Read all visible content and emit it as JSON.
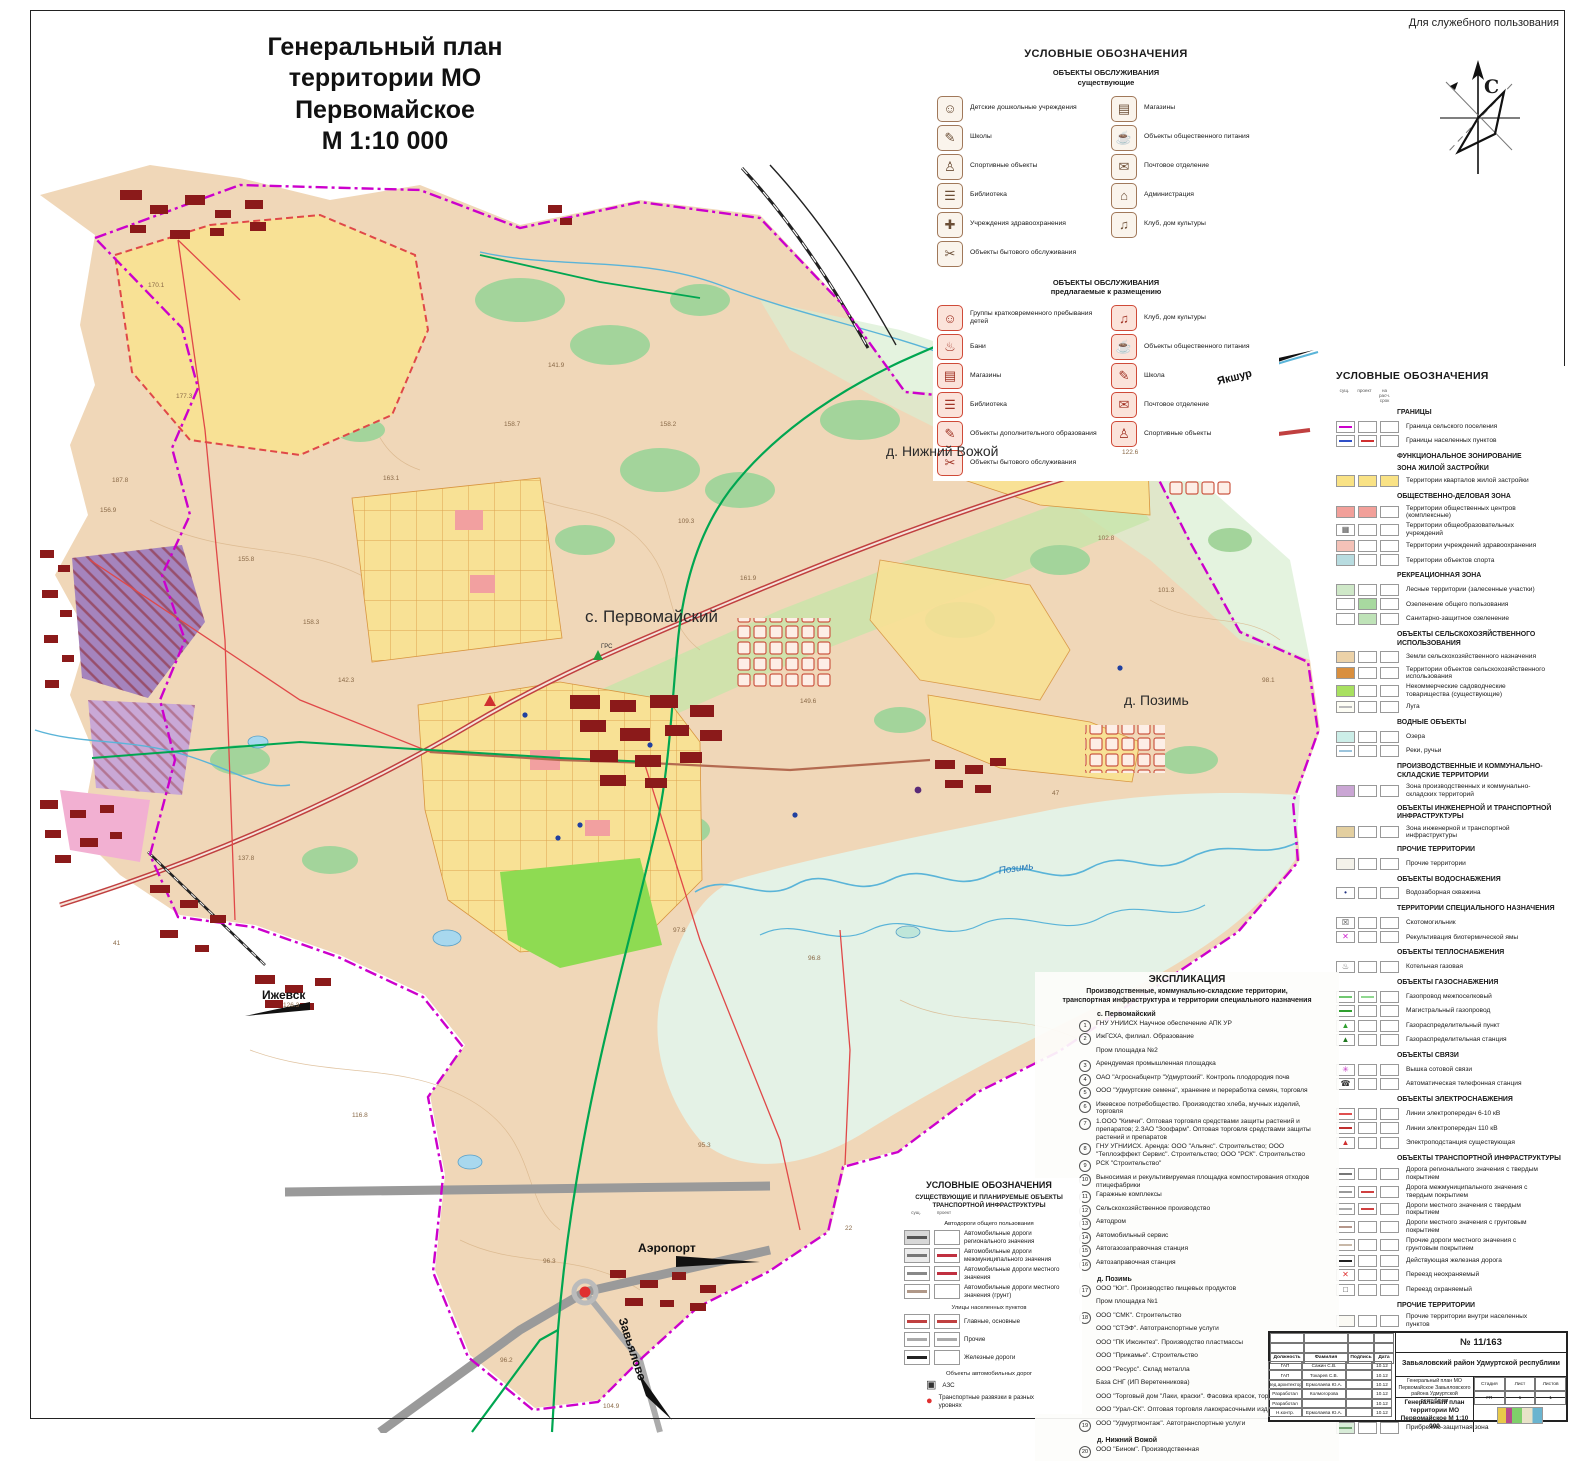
{
  "page": {
    "dsp_note": "Для служебного пользования",
    "title_line1": "Генеральный план",
    "title_line2": "территории МО Первомайское",
    "title_line3": "М 1:10 000",
    "compass_letter": "С"
  },
  "palette": {
    "boundary_magenta": "#cc00cc",
    "residential_yellow": "#f8e195",
    "forest_green": "#a3d49b",
    "gas_green": "#00a651",
    "power_red": "#e04848",
    "industrial_purple": "#a584bd",
    "water_blue": "#5ab4d8",
    "land_tan": "#f0d7b8"
  },
  "services_legend": {
    "title": "УСЛОВНЫЕ ОБОЗНАЧЕНИЯ",
    "existing": {
      "heading1": "ОБЪЕКТЫ ОБСЛУЖИВАНИЯ",
      "heading2": "существующие",
      "left": [
        {
          "icon": "☺",
          "label": "Детские дошкольные учреждения"
        },
        {
          "icon": "✎",
          "label": "Школы"
        },
        {
          "icon": "♙",
          "label": "Спортивные объекты"
        },
        {
          "icon": "☰",
          "label": "Библиотека"
        },
        {
          "icon": "✚",
          "label": "Учреждения здравоохранения"
        },
        {
          "icon": "✂",
          "label": "Объекты бытового обслуживания"
        }
      ],
      "right": [
        {
          "icon": "▤",
          "label": "Магазины"
        },
        {
          "icon": "☕",
          "label": "Объекты общественного питания"
        },
        {
          "icon": "✉",
          "label": "Почтовое отделение"
        },
        {
          "icon": "⌂",
          "label": "Администрация"
        },
        {
          "icon": "♫",
          "label": "Клуб, дом культуры"
        }
      ]
    },
    "proposed": {
      "heading1": "ОБЪЕКТЫ ОБСЛУЖИВАНИЯ",
      "heading2": "предлагаемые к размещению",
      "left": [
        {
          "icon": "☺",
          "label": "Группы кратковременного пребывания детей"
        },
        {
          "icon": "♨",
          "label": "Бани"
        },
        {
          "icon": "▤",
          "label": "Магазины"
        },
        {
          "icon": "☰",
          "label": "Библиотека"
        },
        {
          "icon": "✎",
          "label": "Объекты дополнительного образования"
        },
        {
          "icon": "✂",
          "label": "Объекты бытового обслуживания"
        }
      ],
      "right": [
        {
          "icon": "♫",
          "label": "Клуб, дом культуры"
        },
        {
          "icon": "☕",
          "label": "Объекты общественного питания"
        },
        {
          "icon": "✎",
          "label": "Школа"
        },
        {
          "icon": "✉",
          "label": "Почтовое отделение"
        },
        {
          "icon": "♙",
          "label": "Спортивные объекты"
        }
      ]
    }
  },
  "right_legend": {
    "title": "УСЛОВНЫЕ ОБОЗНАЧЕНИЯ",
    "col_headers": [
      "сущ.",
      "проект",
      "на расч. срок"
    ],
    "rows": [
      {
        "head": "ГРАНИЦЫ",
        "label": "Граница сельского поселения",
        "lc": "#cc00cc"
      },
      {
        "label": "Границы населенных пунктов",
        "lc": "#3050c8",
        "lc2": "#d03030"
      },
      {
        "head": "ФУНКЦИОНАЛЬНОЕ ЗОНИРОВАНИЕ",
        "sub": "ЗОНА ЖИЛОЙ ЗАСТРОЙКИ",
        "label": "Территории кварталов жилой застройки",
        "c": "#f9e285",
        "c2": "#f9e285",
        "c3": "#f9e285"
      },
      {
        "head": "ОБЩЕСТВЕННО-ДЕЛОВАЯ ЗОНА",
        "label": "Территории общественных центров (комплексные)",
        "c": "#f2a09a",
        "c2": "#f2a09a"
      },
      {
        "label": "Территории общеобразовательных учреждений",
        "sym": "▦",
        "symc": "#555"
      },
      {
        "label": "Территории учреждений здравоохранения",
        "c": "#f4c2b8"
      },
      {
        "label": "Территории объектов спорта",
        "c": "#b8dce0"
      },
      {
        "head": "РЕКРЕАЦИОННАЯ ЗОНА",
        "label": "Лесные территории (залесенные участки)",
        "c": "#cfe8c8"
      },
      {
        "label": "Озеленение общего пользования",
        "c2": "#a8d9a0"
      },
      {
        "label": "Санитарно-защитное озеленение",
        "c2": "#bfe3b8"
      },
      {
        "head": "ОБЪЕКТЫ СЕЛЬСКОХОЗЯЙСТВЕННОГО ИСПОЛЬЗОВАНИЯ",
        "label": "Земли сельскохозяйственного назначения",
        "c": "#ecd2a8"
      },
      {
        "label": "Территории объектов сельскохозяйственного использования",
        "c": "#d98f3e"
      },
      {
        "label": "Некоммерческие садоводческие товарищества (существующие)",
        "c": "#a8e060"
      },
      {
        "label": "Луга",
        "c": "#fdfdf4",
        "lc": "#bbb"
      },
      {
        "head": "ВОДНЫЕ ОБЪЕКТЫ",
        "label": "Озера",
        "c": "#cceee8"
      },
      {
        "label": "Реки, ручьи",
        "lc": "#9bc4dc"
      },
      {
        "head": "ПРОИЗВОДСТВЕННЫЕ И КОММУНАЛЬНО-СКЛАДСКИЕ ТЕРРИТОРИИ",
        "label": "Зона производственных и коммунально-складских территорий",
        "c": "#caa6d4"
      },
      {
        "head": "ОБЪЕКТЫ ИНЖЕНЕРНОЙ И ТРАНСПОРТНОЙ ИНФРАСТРУКТУРЫ",
        "label": "Зона инженерной и транспортной инфраструктуры",
        "c": "#e3cfa0"
      },
      {
        "head": "ПРОЧИЕ ТЕРРИТОРИИ",
        "label": "Прочие территории",
        "c": "#f4f2ea"
      },
      {
        "head": "ОБЪЕКТЫ ВОДОСНАБЖЕНИЯ",
        "label": "Водозаборная скважина",
        "sym": "•",
        "symc": "#203080"
      },
      {
        "head": "ТЕРРИТОРИИ СПЕЦИАЛЬНОГО НАЗНАЧЕНИЯ",
        "label": "Скотомогильник",
        "sym": "☒",
        "symc": "#444"
      },
      {
        "label": "Рекультивация биотермической ямы",
        "sym": "✕",
        "symc": "#d020d0"
      },
      {
        "head": "ОБЪЕКТЫ ТЕПЛОСНАБЖЕНИЯ",
        "label": "Котельная газовая",
        "sym": "♨",
        "symc": "#555"
      },
      {
        "head": "ОБЪЕКТЫ ГАЗОСНАБЖЕНИЯ",
        "label": "Газопровод межпоселковый",
        "lc": "#70c870",
        "lc2": "#90d890"
      },
      {
        "label": "Магистральный газопровод",
        "lc": "#30a030"
      },
      {
        "label": "Газораспределительный пункт",
        "sym": "▲",
        "symc": "#30a030"
      },
      {
        "label": "Газораспределительная станция",
        "sym": "▲",
        "symc": "#207820"
      },
      {
        "head": "ОБЪЕКТЫ СВЯЗИ",
        "label": "Вышка сотовой связи",
        "sym": "✳",
        "symc": "#c030c0"
      },
      {
        "label": "Автоматическая телефонная станция",
        "sym": "☎",
        "symc": "#333"
      },
      {
        "head": "ОБЪЕКТЫ ЭЛЕКТРОСНАБЖЕНИЯ",
        "label": "Линии электропередач 6-10 кВ",
        "lc": "#e05050"
      },
      {
        "label": "Линии электропередач 110 кВ",
        "lc": "#c03030"
      },
      {
        "label": "Электроподстанция  существующая",
        "sym": "▲",
        "symc": "#d03030"
      },
      {
        "head": "ОБЪЕКТЫ ТРАНСПОРТНОЙ ИНФРАСТРУКТУРЫ",
        "label": "Дорога регионального значения с твердым покрытием",
        "lc": "#777"
      },
      {
        "label": "Дорога межмуниципального значения с твердым покрытием",
        "lc": "#999",
        "lc2": "#d04040"
      },
      {
        "label": "Дороги местного значения с твердым покрытием",
        "lc": "#aaa",
        "lc2": "#d04040"
      },
      {
        "label": "Дороги местного значения с грунтовым покрытием",
        "lc": "#b5968a"
      },
      {
        "label": "Прочие дороги местного значения с грунтовым покрытием",
        "lc": "#c8b8a8"
      },
      {
        "label": "Действующая железная дорога",
        "lc": "#222"
      },
      {
        "label": "Переезд неохраняемый",
        "sym": "✕",
        "symc": "#e03030"
      },
      {
        "label": "Переезд охраняемый",
        "sym": "□",
        "symc": "#333"
      },
      {
        "head": "ПРОЧИЕ ТЕРРИТОРИИ",
        "label": "Прочие территории внутри населенных пунктов",
        "c": "#fbfaf4"
      },
      {
        "head": "ЗОНЫ С ОСОБЫМИ УСЛОВИЯМИ",
        "label": "Санитарно-защитная зона",
        "c": "#e4e4e4",
        "lc": "#888"
      },
      {
        "label": "Водоохранная зона",
        "c": "#eef2fa",
        "lc": "#4878c8"
      },
      {
        "label": "Полоса отвода от газопровода",
        "c": "#c2ecc2"
      },
      {
        "label": "Полоса отвода от линии электропередач",
        "c": "#ddc2e0"
      },
      {
        "label": "Зона санитарной охраны и источников питьевого водоснабжения I пояса",
        "c": "#f0c2dc",
        "lc": "#c050a0"
      },
      {
        "label": "Прибрежно-защитная зона",
        "c": "#d8ecd8",
        "lc": "#70a070"
      }
    ]
  },
  "explication": {
    "title": "ЭКСПЛИКАЦИЯ",
    "subtitle1": "Производственные, коммунально-складские территории,",
    "subtitle2": "транспортная инфраструктура и территории специального назначения",
    "rows": [
      {
        "head": "с. Первомайский",
        "n": "1",
        "text": "ГНУ УНИИСХ Научное обеспечение АПК УР"
      },
      {
        "n": "2",
        "text": "ИжГСХА, филиал. Образование"
      },
      {
        "n": "",
        "text": "Пром площадка №2"
      },
      {
        "n": "3",
        "text": "Арендуемая промышленная площадка"
      },
      {
        "n": "4",
        "text": "ОАО \"Агроснабцентр \"Удмуртский\". Контроль плодородия почв"
      },
      {
        "n": "5",
        "text": "ООО \"Удмуртские семена\", хранение и переработка семян, торговля"
      },
      {
        "n": "6",
        "text": "Ижевское потребобщество. Производство хлеба, мучных изделий, торговля"
      },
      {
        "n": "7",
        "text": "1.ООО \"Кимчи\". Оптовая торговля средствами защиты растений и препаратов; 2.ЗАО \"Зоофарм\". Оптовая торговля средствами защиты растений и препаратов"
      },
      {
        "n": "8",
        "text": "ГНУ УГНИИСХ. Аренда: ООО \"Альянс\". Строительство; ООО \"Теплоэффект Сервис\". Строительство; ООО \"РСК\". Строительство"
      },
      {
        "n": "9",
        "text": "РСК \"Строительство\""
      },
      {
        "n": "10",
        "text": "Выносимая и рекультивируемая площадка компостирования отходов птицефабрики"
      },
      {
        "n": "11",
        "text": "Гаражные комплексы"
      },
      {
        "n": "12",
        "text": "Сельскохозяйственное производство"
      },
      {
        "n": "13",
        "text": "Автодром"
      },
      {
        "n": "14",
        "text": "Автомобильный сервис"
      },
      {
        "n": "15",
        "text": "Автогазозаправочная станция"
      },
      {
        "n": "16",
        "text": "Автозаправочная станция"
      },
      {
        "head": "д. Позимь",
        "n": "17",
        "text": "ООО \"Юг\". Производство пищевых продуктов"
      },
      {
        "n": "",
        "text": "Пром площадка №1"
      },
      {
        "n": "18",
        "text": "ООО \"СМК\". Строительство"
      },
      {
        "n": "",
        "text": "ООО \"СТЭФ\". Автотранспортные услуги"
      },
      {
        "n": "",
        "text": "ООО \"ПК Ижсинтез\". Производство пластмассы"
      },
      {
        "n": "",
        "text": "ООО \"Прикамье\". Строительство"
      },
      {
        "n": "",
        "text": "ООО \"Ресурс\". Склад металла"
      },
      {
        "n": "",
        "text": "База СНГ (ИП Веретенникова)"
      },
      {
        "n": "",
        "text": "ООО \"Торговый дом \"Лаки, краски\". Фасовка красок, торговля"
      },
      {
        "n": "",
        "text": "ООО \"Урал-СК\". Оптовая торговля лакокрасочными изделиями"
      },
      {
        "n": "19",
        "text": "ООО \"Удмуртмонтаж\". Автотранспортные услуги"
      },
      {
        "head": "д. Нижний Вожой",
        "n": "20",
        "text": "ООО \"Бином\". Производственная"
      }
    ]
  },
  "transport_legend": {
    "title": "УСЛОВНЫЕ ОБОЗНАЧЕНИЯ",
    "subtitle1": "СУЩЕСТВУЮЩИЕ И ПЛАНИРУЕМЫЕ ОБЪЕКТЫ",
    "subtitle2": "ТРАНСПОРТНОЙ ИНФРАСТРУКТУРЫ",
    "col_headers": [
      "сущ.",
      "проект"
    ],
    "rows": [
      {
        "head": "Автодороги общего пользования",
        "label": "Автомобильные дороги регионального значения",
        "c": "#d8d8d8",
        "lc": "#555"
      },
      {
        "label": "Автомобильные дороги межмуниципального значения",
        "c": "#ececec",
        "lc": "#777",
        "lc2": "#c03040"
      },
      {
        "label": "Автомобильные дороги местного значения",
        "lc": "#888",
        "lc2": "#c03040"
      },
      {
        "label": "Автомобильные дороги местного значения (грунт)",
        "lc": "#b09888"
      },
      {
        "head": "Улицы населенных пунктов",
        "label": "Главные, основные",
        "lc": "#c04040",
        "lc2": "#c04040"
      },
      {
        "label": "Прочие",
        "lc": "#aaa",
        "lc2": "#aaa"
      },
      {
        "label": "Железные дороги",
        "lc": "#222"
      },
      {
        "head": "Объекты автомобильных дорог",
        "label": "АЗС",
        "kind": "icononly",
        "sym": "▣",
        "symc": "#333"
      },
      {
        "label": "Транспортные развязки в разных уровнях",
        "kind": "icononly",
        "sym": "●",
        "symc": "#e03030"
      }
    ]
  },
  "title_block": {
    "number": "№ 11/163",
    "region": "Завьяловский район Удмуртской республики",
    "header": {
      "role": "Должность",
      "name": "Фамилия",
      "sign": "Подпись",
      "date": "Дата"
    },
    "persons": [
      {
        "role": "ГАП",
        "name": "Сажин С.В.",
        "sign": "",
        "date": "10.12"
      },
      {
        "role": "ГАП",
        "name": "Токарев С.В.",
        "sign": "",
        "date": "10.12"
      },
      {
        "role": "Вед.архитектор",
        "name": "Ермолаева Ю.А.",
        "sign": "",
        "date": "10.12"
      },
      {
        "role": "Разработал",
        "name": "Колмогорова",
        "sign": "",
        "date": "10.12"
      },
      {
        "role": "Разработал",
        "name": "",
        "sign": "",
        "date": "10.12"
      },
      {
        "role": "Н.контр.",
        "name": "Ермолаева Ю.А.",
        "sign": "",
        "date": "10.12"
      }
    ],
    "project": "Генеральный план МО Первомайское Завьяловского района Удмуртской республики",
    "stage_labels": [
      "Стадия",
      "Лист",
      "Листов"
    ],
    "stage_values": [
      "ГП",
      "1",
      "1"
    ],
    "doc_title": "Генеральный план территории МО Первомайское М 1:10 000"
  },
  "map": {
    "labels": [
      {
        "text": "с. Первомайский",
        "x": 585,
        "y": 607,
        "cls": "settlement",
        "fs": 17,
        "rot": "none"
      },
      {
        "text": "д. Нижний Вожой",
        "x": 886,
        "y": 443,
        "cls": "settlement",
        "fs": 14,
        "rot": "none"
      },
      {
        "text": "д. Позимь",
        "x": 1124,
        "y": 692,
        "cls": "settlement",
        "fs": 14,
        "rot": "none"
      },
      {
        "text": "Ижевск",
        "x": 262,
        "y": 988,
        "cls": "city",
        "fs": 12,
        "rot": "none"
      },
      {
        "text": "Аэропорт",
        "x": 638,
        "y": 1241,
        "cls": "city",
        "fs": 12,
        "rot": "none"
      },
      {
        "text": "Завьялово",
        "x": 629,
        "y": 1316,
        "cls": "city",
        "fs": 12,
        "rot": "rotate(72deg)"
      },
      {
        "text": "Якшур",
        "x": 1216,
        "y": 376,
        "cls": "city",
        "fs": 11,
        "rot": "rotate(-14deg)"
      },
      {
        "text": "Позимь",
        "x": 998,
        "y": 866,
        "cls": "river",
        "fs": 10,
        "rot": "rotate(-8deg)"
      },
      {
        "text": "ГРС",
        "x": 601,
        "y": 644,
        "cls": "tiny",
        "fs": 6,
        "rot": "none"
      }
    ],
    "elevations": [
      {
        "v": "170.1",
        "x": 148,
        "y": 282
      },
      {
        "v": "177.3",
        "x": 176,
        "y": 393
      },
      {
        "v": "187.8",
        "x": 112,
        "y": 477
      },
      {
        "v": "156.9",
        "x": 100,
        "y": 507
      },
      {
        "v": "155.8",
        "x": 238,
        "y": 556
      },
      {
        "v": "158.3",
        "x": 303,
        "y": 619
      },
      {
        "v": "163.1",
        "x": 383,
        "y": 475
      },
      {
        "v": "142.3",
        "x": 338,
        "y": 677
      },
      {
        "v": "137.8",
        "x": 238,
        "y": 855
      },
      {
        "v": "158.7",
        "x": 504,
        "y": 421
      },
      {
        "v": "141.9",
        "x": 548,
        "y": 362
      },
      {
        "v": "158.2",
        "x": 660,
        "y": 421
      },
      {
        "v": "109.3",
        "x": 678,
        "y": 518
      },
      {
        "v": "161.9",
        "x": 740,
        "y": 575
      },
      {
        "v": "149.6",
        "x": 800,
        "y": 698
      },
      {
        "v": "122.6",
        "x": 1122,
        "y": 449
      },
      {
        "v": "102.8",
        "x": 1098,
        "y": 535
      },
      {
        "v": "101.3",
        "x": 1158,
        "y": 587
      },
      {
        "v": "98.1",
        "x": 1262,
        "y": 677
      },
      {
        "v": "97.8",
        "x": 673,
        "y": 927
      },
      {
        "v": "96.8",
        "x": 808,
        "y": 955
      },
      {
        "v": "95.3",
        "x": 698,
        "y": 1142
      },
      {
        "v": "96.3",
        "x": 543,
        "y": 1258
      },
      {
        "v": "96.2",
        "x": 500,
        "y": 1357
      },
      {
        "v": "104.9",
        "x": 603,
        "y": 1403
      },
      {
        "v": "126.3",
        "x": 283,
        "y": 1002
      },
      {
        "v": "116.8",
        "x": 352,
        "y": 1112
      },
      {
        "v": "47",
        "x": 1052,
        "y": 790
      },
      {
        "v": "41",
        "x": 113,
        "y": 940
      },
      {
        "v": "22",
        "x": 845,
        "y": 1225
      }
    ]
  }
}
